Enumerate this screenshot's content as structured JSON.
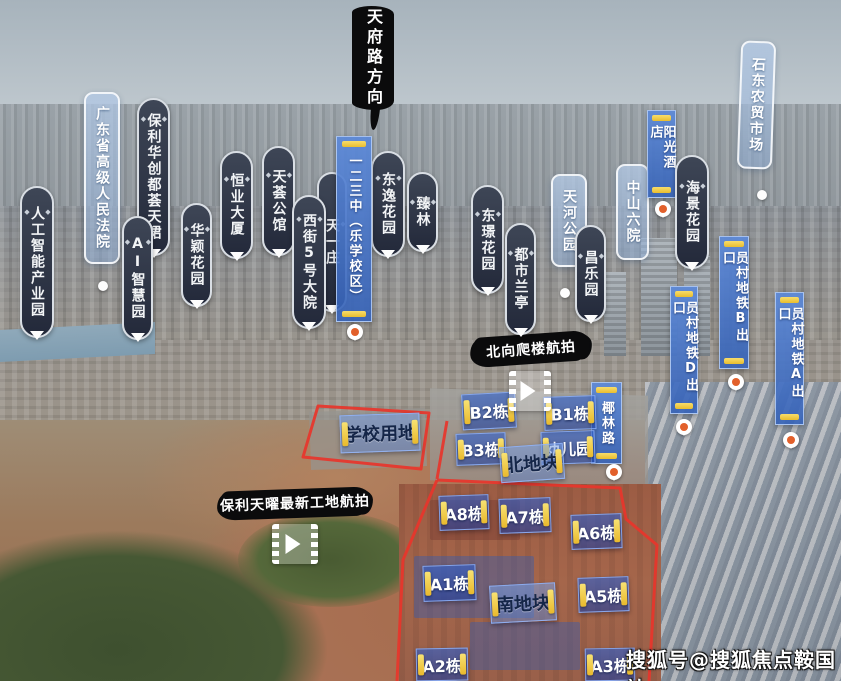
{
  "watermark": {
    "text": "搜狐号@搜狐焦点鞍国站"
  },
  "colors": {
    "sky": "#aab6bf",
    "ink_banner": "#0b0b0c",
    "capsule_dark": "#2b3140",
    "capsule_border": "#d9dee4",
    "glass_blue": "#a5bedd",
    "flag_blue": "#3f6fc4",
    "accent_yellow": "#eec33a",
    "boundary_red": "#e8352b",
    "box_blue": "#2f60cd",
    "pin_orange": "#e2602b"
  },
  "labels": [
    {
      "text": "天府路方向",
      "style": "ink-v",
      "x": 352,
      "y": 6,
      "w": 42,
      "h": 104
    },
    {
      "text": "北向爬楼航拍",
      "style": "ink-h",
      "x": 472,
      "y": 334,
      "w": 118,
      "h": 29,
      "r": -4
    },
    {
      "text": "保利天曜最新工地航拍",
      "style": "ink-h",
      "x": 219,
      "y": 489,
      "w": 152,
      "h": 28,
      "r": -2
    },
    {
      "text": "人工智能产业园",
      "style": "capsule",
      "x": 20,
      "y": 186,
      "w": 34,
      "h": 152
    },
    {
      "text": "广东省高级人民法院",
      "style": "glass",
      "x": 84,
      "y": 92,
      "w": 36,
      "h": 172
    },
    {
      "text": "保利华创都荟天珺",
      "style": "capsule",
      "x": 137,
      "y": 98,
      "w": 33,
      "h": 158
    },
    {
      "text": "AI智慧园",
      "style": "capsule",
      "x": 122,
      "y": 216,
      "w": 31,
      "h": 124
    },
    {
      "text": "华颖花园",
      "style": "capsule",
      "x": 181,
      "y": 203,
      "w": 31,
      "h": 104
    },
    {
      "text": "恒业大厦",
      "style": "capsule",
      "x": 220,
      "y": 151,
      "w": 33,
      "h": 108
    },
    {
      "text": "天荟公馆",
      "style": "capsule",
      "x": 262,
      "y": 146,
      "w": 33,
      "h": 110
    },
    {
      "text": "天一庄",
      "style": "capsule",
      "x": 317,
      "y": 172,
      "w": 30,
      "h": 140,
      "z": 1
    },
    {
      "text": "西街5号大院",
      "style": "capsule",
      "x": 292,
      "y": 195,
      "w": 34,
      "h": 134,
      "z": 2
    },
    {
      "text": "一二三中（乐学校区）",
      "style": "flag",
      "x": 336,
      "y": 136,
      "w": 36,
      "h": 186,
      "z": 3
    },
    {
      "text": "东逸花园",
      "style": "capsule",
      "x": 371,
      "y": 151,
      "w": 34,
      "h": 106
    },
    {
      "text": "臻林",
      "style": "capsule",
      "x": 407,
      "y": 172,
      "w": 31,
      "h": 80
    },
    {
      "text": "东璟花园",
      "style": "capsule",
      "x": 471,
      "y": 185,
      "w": 33,
      "h": 109
    },
    {
      "text": "都市兰亭",
      "style": "capsule",
      "x": 505,
      "y": 223,
      "w": 31,
      "h": 112
    },
    {
      "text": "天河公园",
      "style": "glass",
      "x": 551,
      "y": 174,
      "w": 36,
      "h": 93
    },
    {
      "text": "昌乐园",
      "style": "capsule",
      "x": 575,
      "y": 225,
      "w": 31,
      "h": 97,
      "z": 2
    },
    {
      "text": "中山六院",
      "style": "glass",
      "x": 616,
      "y": 164,
      "w": 33,
      "h": 96
    },
    {
      "text": "阳光酒店",
      "style": "flag",
      "x": 647,
      "y": 110,
      "w": 29,
      "h": 88,
      "z": 2
    },
    {
      "text": "海景花园",
      "style": "capsule",
      "x": 675,
      "y": 155,
      "w": 34,
      "h": 114,
      "z": 3
    },
    {
      "text": "石东农贸市场",
      "style": "glass",
      "x": 739,
      "y": 41,
      "w": 35,
      "h": 128,
      "r": 2
    },
    {
      "text": "员村地铁B出口",
      "style": "flag",
      "x": 719,
      "y": 236,
      "w": 30,
      "h": 133
    },
    {
      "text": "员村地铁D出口",
      "style": "flag",
      "x": 670,
      "y": 286,
      "w": 28,
      "h": 128
    },
    {
      "text": "员村地铁A出口",
      "style": "flag",
      "x": 775,
      "y": 292,
      "w": 29,
      "h": 133
    },
    {
      "text": "椰林路",
      "style": "flag",
      "x": 591,
      "y": 382,
      "w": 31,
      "h": 82
    },
    {
      "text": "B2栋",
      "style": "box",
      "x": 462,
      "y": 393,
      "w": 54,
      "h": 36,
      "r": -3
    },
    {
      "text": "B1栋",
      "style": "box",
      "x": 544,
      "y": 396,
      "w": 52,
      "h": 34,
      "r": -2
    },
    {
      "text": "B3栋",
      "style": "box",
      "x": 456,
      "y": 433,
      "w": 50,
      "h": 32,
      "r": -2
    },
    {
      "text": "幼儿园",
      "style": "box",
      "x": 541,
      "y": 431,
      "w": 54,
      "h": 33,
      "r": -2
    },
    {
      "text": "学校用地",
      "style": "plate",
      "x": 340,
      "y": 414,
      "w": 80,
      "h": 38,
      "r": -2
    },
    {
      "text": "北地块",
      "style": "plate",
      "x": 500,
      "y": 445,
      "w": 64,
      "h": 36,
      "r": -4
    },
    {
      "text": "A8栋",
      "style": "box",
      "x": 439,
      "y": 495,
      "w": 50,
      "h": 35,
      "r": -2
    },
    {
      "text": "A7栋",
      "style": "box",
      "x": 499,
      "y": 498,
      "w": 52,
      "h": 35,
      "r": -2
    },
    {
      "text": "A6栋",
      "style": "box",
      "x": 571,
      "y": 514,
      "w": 51,
      "h": 35,
      "r": -2
    },
    {
      "text": "A1栋",
      "style": "box",
      "x": 423,
      "y": 565,
      "w": 53,
      "h": 36,
      "r": -2
    },
    {
      "text": "南地块",
      "style": "plate",
      "x": 490,
      "y": 584,
      "w": 66,
      "h": 38,
      "r": -3
    },
    {
      "text": "A5栋",
      "style": "box",
      "x": 578,
      "y": 577,
      "w": 51,
      "h": 35,
      "r": -2
    },
    {
      "text": "A2栋",
      "style": "box",
      "x": 416,
      "y": 648,
      "w": 52,
      "h": 33,
      "r": -1
    },
    {
      "text": "A3栋",
      "style": "box",
      "x": 585,
      "y": 648,
      "w": 50,
      "h": 33,
      "r": -1
    }
  ],
  "pins": [
    {
      "x": 347,
      "y": 324
    },
    {
      "x": 655,
      "y": 201
    },
    {
      "x": 728,
      "y": 374
    },
    {
      "x": 676,
      "y": 419
    },
    {
      "x": 783,
      "y": 432
    },
    {
      "x": 606,
      "y": 464
    }
  ],
  "dots": [
    {
      "x": 98,
      "y": 281
    },
    {
      "x": 560,
      "y": 288
    },
    {
      "x": 757,
      "y": 190
    }
  ],
  "videos": [
    {
      "x": 509,
      "y": 371,
      "w": 42,
      "h": 40
    },
    {
      "x": 272,
      "y": 524,
      "w": 46,
      "h": 40
    }
  ]
}
